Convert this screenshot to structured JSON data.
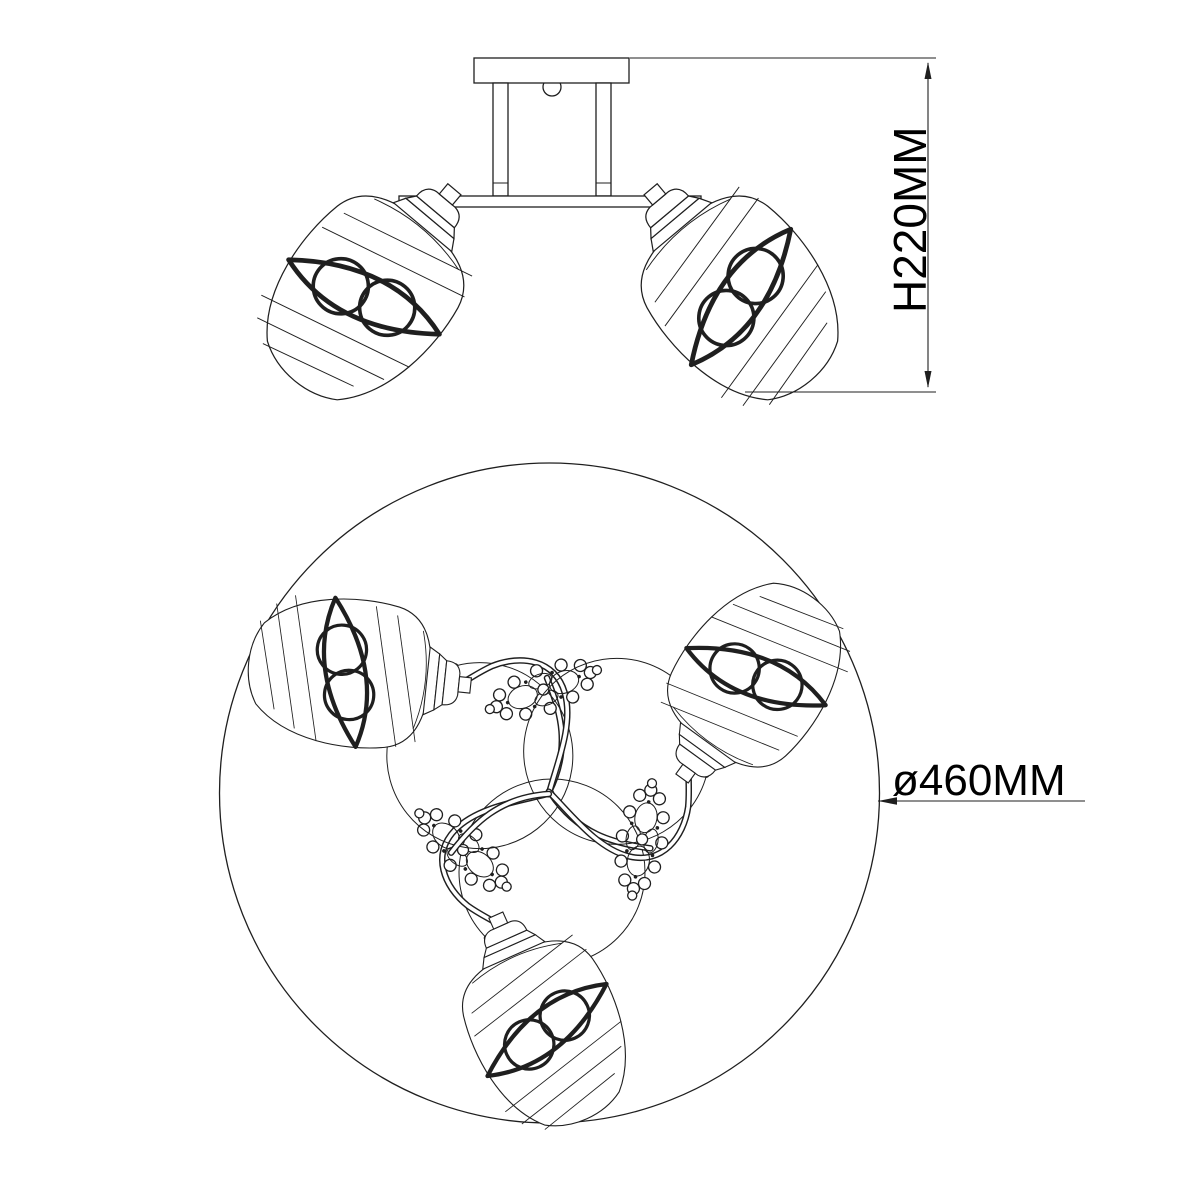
{
  "labels": {
    "height": "H220MM",
    "diameter": "ø460MM"
  },
  "colors": {
    "background": "#ffffff",
    "line": "#1f1f1f",
    "text": "#000000"
  }
}
